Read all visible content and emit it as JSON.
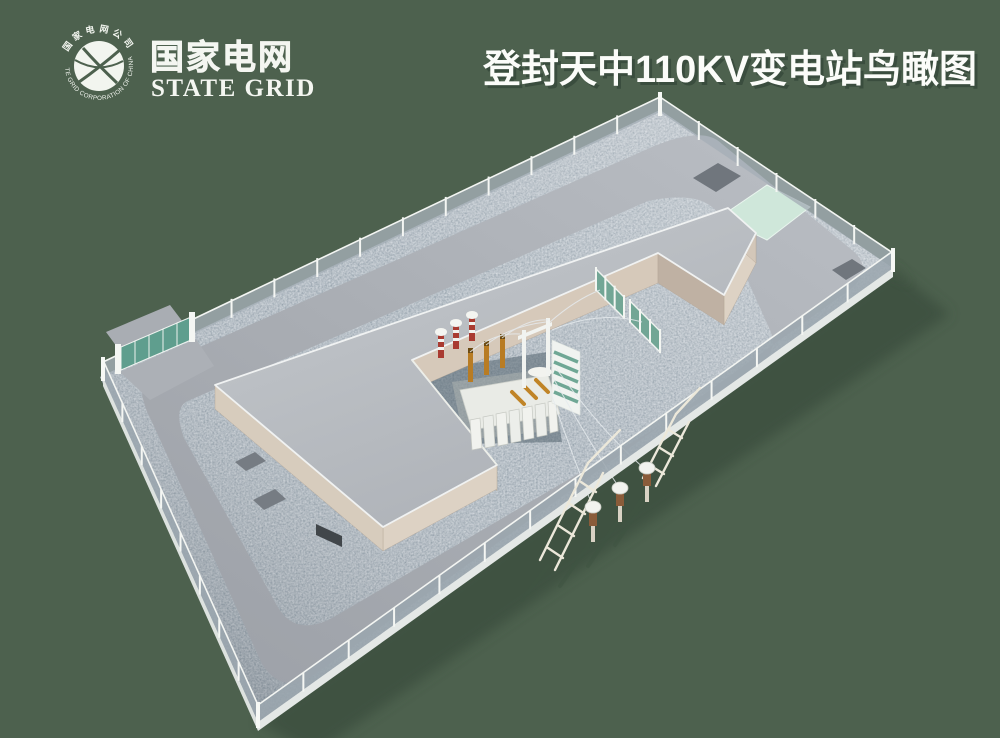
{
  "header": {
    "logo": {
      "emblem_top_text": "国家电网公司",
      "emblem_bottom_text": "STATE GRID CORPORATION OF CHINA",
      "name_cn": "国家电网",
      "name_en": "STATE GRID"
    },
    "title": "登封天中110KV变电站鸟瞰图"
  },
  "scene": {
    "type": "3d-aerial-rendering",
    "subject": "110KV substation bird's-eye view",
    "elements": [
      "perimeter-fence",
      "entrance-gate",
      "ring-road",
      "gravel-yard",
      "l-shaped-building",
      "main-transformer",
      "transformer-bay",
      "surge-arresters",
      "bushings",
      "gantry",
      "green-screen-fence",
      "mint-equipment-pad",
      "dark-equipment-pads",
      "terminal-poles",
      "guyed-towers",
      "overhead-lines"
    ]
  },
  "colors": {
    "background": "#4d614e",
    "shadow_green": "#3a4e3d",
    "road": "#a9adb3",
    "roof": "#b8bcc1",
    "wall_beige": "#d9cdbf",
    "gravel_dark": "#293a4a",
    "gravel_light": "#d9e0e8",
    "fence_white": "#f4f6f3",
    "gate_green": "#5f9e8e",
    "mint_pad": "#cfe7da",
    "bushing_orange": "#b87c24",
    "arrester_red": "#a93b31",
    "text_white": "#f7f9f5"
  }
}
